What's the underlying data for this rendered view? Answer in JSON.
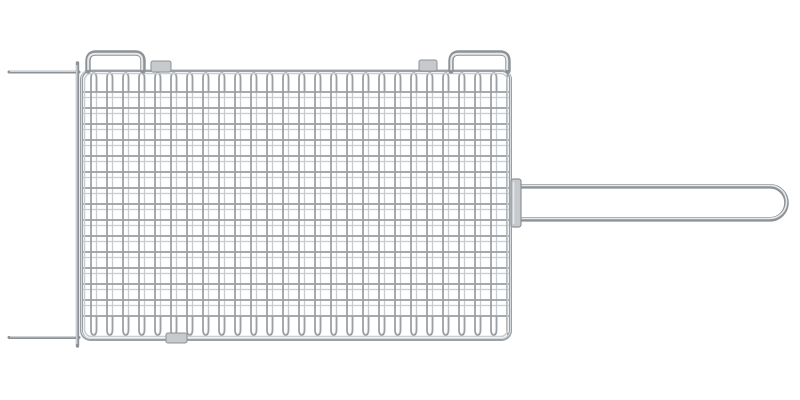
{
  "meta": {
    "object": "barbecue-grill-basket",
    "alt": "Chrome-plated wire barbecue grill basket with fine square mesh, two latch loops and a sliding clip on the top edge, a clip on the bottom edge, two prongs extending to the left, and a long looped metal handle extending to the right, on a plain white background"
  },
  "colors": {
    "background": "#ffffff",
    "wire_main": "#9aa0a5",
    "wire_dark": "#8d9296",
    "wire_light": "#c9cdd1",
    "wire_highlight": "#e6e8ea",
    "metal_fill": "#c6cacd"
  }
}
